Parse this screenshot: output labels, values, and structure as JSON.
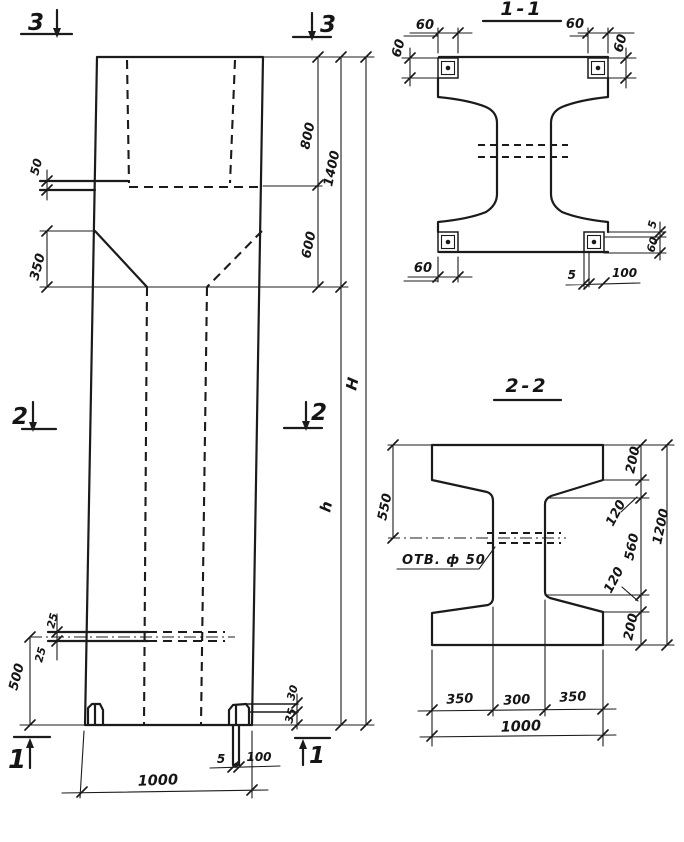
{
  "paper_color": "#ffffff",
  "ink_color": "#1b1b1b",
  "elevation": {
    "markers": {
      "m3_left": "3",
      "m3_right": "3",
      "m2_left": "2",
      "m2_right": "2",
      "m1_left": "1",
      "m1_right": "1"
    },
    "dims": {
      "plate_offset_50": "50",
      "taper_height_350": "350",
      "top_800": "800",
      "top_1400": "1400",
      "top_600": "600",
      "total_height_H": "H",
      "shaft_height_h": "h",
      "hole_upper_25": "25",
      "hole_lower_25": "25",
      "hole_elevation_500": "500",
      "foot_30": "30",
      "foot_35": "35",
      "base_plate_5": "5",
      "base_plate_100": "100",
      "width_1000": "1000"
    }
  },
  "section_1_1": {
    "title": "1-1",
    "dims": {
      "plate_tl_width_60": "60",
      "plate_tl_height_60": "60",
      "plate_tr_width_60": "60",
      "plate_tr_height_60": "60",
      "plate_bl_width_60": "60",
      "plate_br_thickness_5": "5",
      "plate_br_width_100": "100",
      "right_gap_5": "5",
      "right_plate_60": "60"
    }
  },
  "section_2_2": {
    "title": "2-2",
    "hole_label": "ОТВ. ф 50",
    "dims": {
      "flange_550": "550",
      "top_200": "200",
      "upper_120": "120",
      "web_560": "560",
      "lower_120": "120",
      "bottom_200": "200",
      "height_1200": "1200",
      "bottom_350_left": "350",
      "bottom_300": "300",
      "bottom_350_right": "350",
      "bottom_1000": "1000"
    }
  }
}
